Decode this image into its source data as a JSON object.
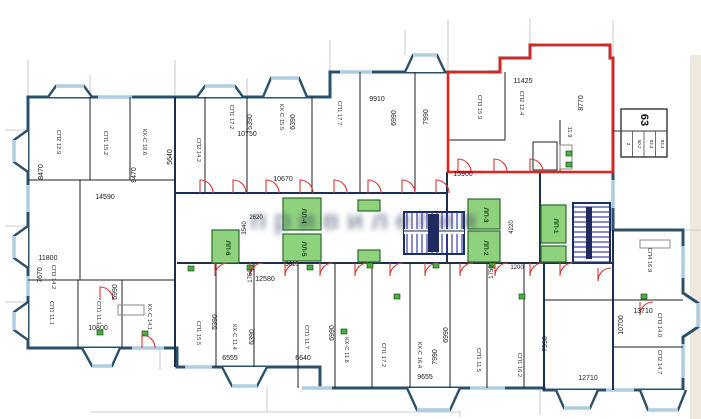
{
  "stamp": {
    "number": "63",
    "cells": [
      {
        "t": "3"
      },
      {
        "t": "50.2"
      },
      {
        "t": "83.3"
      },
      {
        "t": "83.3"
      }
    ]
  },
  "watermark": {
    "text": "привилегия"
  },
  "cores": [
    {
      "label": "ЛЛ-4"
    },
    {
      "label": "ЛЛ-5"
    },
    {
      "label": "ЛП-6"
    },
    {
      "label": "ЛП-3"
    },
    {
      "label": "ЛП-2"
    },
    {
      "label": "ЛП-1"
    }
  ],
  "dims": {
    "h": [
      {
        "t": "11425"
      },
      {
        "t": "9910"
      },
      {
        "t": "10750"
      },
      {
        "t": "15900"
      },
      {
        "t": "10670"
      },
      {
        "t": "14590"
      },
      {
        "t": "2620"
      },
      {
        "t": "3610"
      },
      {
        "t": "12580"
      },
      {
        "t": "11800"
      },
      {
        "t": "10800"
      },
      {
        "t": "6555"
      },
      {
        "t": "6640"
      },
      {
        "t": "9655"
      },
      {
        "t": "13710"
      },
      {
        "t": "12710"
      },
      {
        "t": "1200"
      }
    ],
    "v": [
      {
        "t": "8770"
      },
      {
        "t": "5390"
      },
      {
        "t": "6390"
      },
      {
        "t": "6990"
      },
      {
        "t": "7990"
      },
      {
        "t": "5640"
      },
      {
        "t": "8470"
      },
      {
        "t": "9470"
      },
      {
        "t": "3540"
      },
      {
        "t": "1750"
      },
      {
        "t": "5390"
      },
      {
        "t": "6390"
      },
      {
        "t": "6990"
      },
      {
        "t": "6990"
      },
      {
        "t": "7990"
      },
      {
        "t": "7670"
      },
      {
        "t": "6990"
      },
      {
        "t": "10700"
      },
      {
        "t": "7990"
      },
      {
        "t": "1750"
      },
      {
        "t": "4220"
      }
    ]
  },
  "rooms": [
    {
      "t": "СП2 12.9"
    },
    {
      "t": "СП1 15.2"
    },
    {
      "t": "КХ-С 18.6"
    },
    {
      "t": "СП2 14.2"
    },
    {
      "t": "СП1 17.2"
    },
    {
      "t": "КХ-С 15.5"
    },
    {
      "t": "СП1 17.7"
    },
    {
      "t": "СП3 15.9"
    },
    {
      "t": "СП2 12.4"
    },
    {
      "t": "11.9"
    },
    {
      "t": "СП3 14.2"
    },
    {
      "t": "СП1 11.1"
    },
    {
      "t": "СП1 11.1"
    },
    {
      "t": "КХ-С 14.1"
    },
    {
      "t": "СП1 15.5"
    },
    {
      "t": "КХ-С 11.4"
    },
    {
      "t": "СП1 11.7"
    },
    {
      "t": "КХ-С 11.6"
    },
    {
      "t": "СП1 17.2"
    },
    {
      "t": "КХ-С 16.4"
    },
    {
      "t": "СП1 11.5"
    },
    {
      "t": "СП1 16.2"
    },
    {
      "t": "СП4 16.9"
    },
    {
      "t": "СП3 14.0"
    },
    {
      "t": "СП2 14.7"
    }
  ],
  "colors": {
    "wall": "#2b506b",
    "highlight": "#e2231d",
    "core_green": "#8fd27e",
    "stair_blue": "#3c3cae",
    "window": "#aecde0",
    "page_edge": "#efe8dc"
  }
}
